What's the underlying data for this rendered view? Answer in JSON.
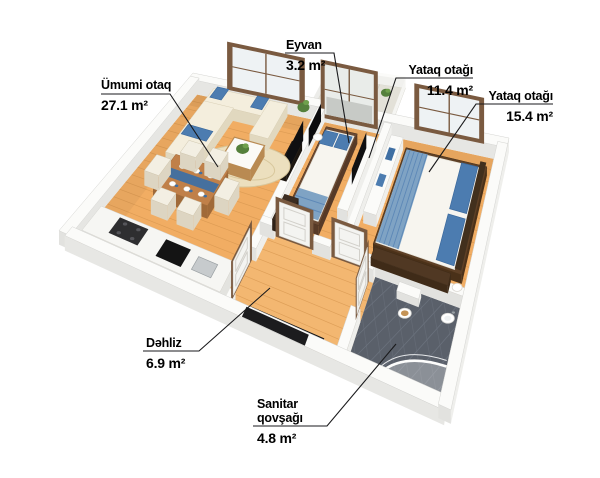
{
  "scene": {
    "type": "3d-floor-plan-rendering",
    "background": "#ffffff",
    "unit_suffix": "m²"
  },
  "rooms": {
    "living": {
      "name": "Ümumi otaq",
      "area": "27.1 m²"
    },
    "balcony": {
      "name": "Eyvan",
      "area": "3.2 m²"
    },
    "bedroom1": {
      "name": "Yataq otağı",
      "area": "11.4 m²"
    },
    "bedroom2": {
      "name": "Yataq otağı",
      "area": "15.4 m²"
    },
    "hallway": {
      "name": "Dəhliz",
      "area": "6.9 m²"
    },
    "bathroom": {
      "name": "Sanitar qovşağı",
      "area": "4.8 m²"
    }
  },
  "colors": {
    "leader": "#1a1a1c",
    "wood": "#f1ad63",
    "wood_line": "#d79750",
    "wood_hall": "#f3b771",
    "wall_top": "#fbfbf9",
    "wall_face": "#e2e2df",
    "wall_face2": "#efefec",
    "wall_edge": "#d4d4d1",
    "tile": "#5a606a",
    "tile_line": "#6e7580",
    "balcony_tile": "#e3e1d8",
    "frame": "#7a5a40",
    "frame_dark": "#55402c",
    "glass": "#eef2f4",
    "door": "#f4f4f1",
    "sofa": "#f4eedd",
    "sofa_face": "#e1d8bf",
    "blue": "#3f6fa3",
    "blue_mid": "#5d88b7",
    "blue_light": "#7fa3c4",
    "pillow": "#4c7cb0",
    "table": "#c08049",
    "table_face": "#a06a39",
    "counter": "#f6f6f3",
    "counter_face": "#e3e3df",
    "bedframe1": "#6b4a33",
    "bedframe2": "#5e4026",
    "headboard": "#42301d",
    "mattress": "#f7f5ef",
    "dark": "#141416",
    "green": "#55803c",
    "green2": "#6fa04c",
    "white": "#fbfbf9"
  }
}
